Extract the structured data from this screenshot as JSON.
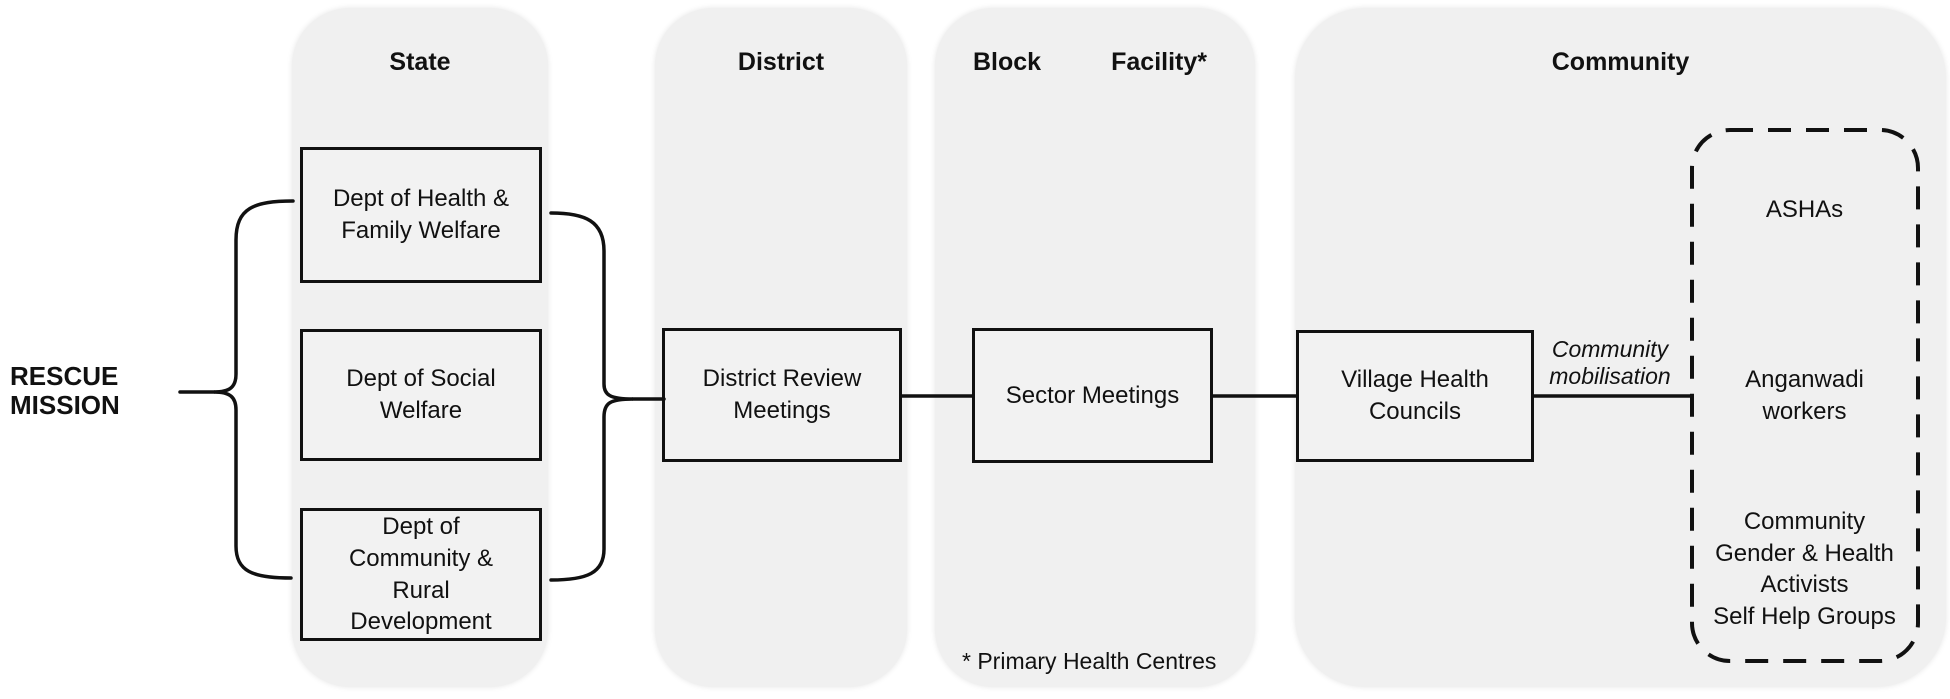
{
  "left_label": "RESCUE\nMISSION",
  "columns": {
    "state": {
      "label": "State"
    },
    "district": {
      "label": "District"
    },
    "block": {
      "label": "Block",
      "label_right": "Facility*"
    },
    "community": {
      "label": "Community"
    }
  },
  "nodes": {
    "state_boxes": [
      "Dept of Health &\nFamily Welfare",
      "Dept of Social\nWelfare",
      "Dept of\nCommunity &\nRural\nDevelopment"
    ],
    "district_box": "District Review\nMeetings",
    "block_box": "Sector Meetings",
    "community_box": "Village Health\nCouncils"
  },
  "edge_label": "Community\nmobilisation",
  "dashed_group": {
    "items": [
      "ASHAs",
      "Anganwadi\nworkers",
      "Community\nGender & Health\nActivists\nSelf Help Groups"
    ]
  },
  "footnote": "* Primary Health Centres",
  "colors": {
    "column_bg": "#f0f0f0",
    "box_bg": "#f2f2f2",
    "line": "#111111"
  }
}
